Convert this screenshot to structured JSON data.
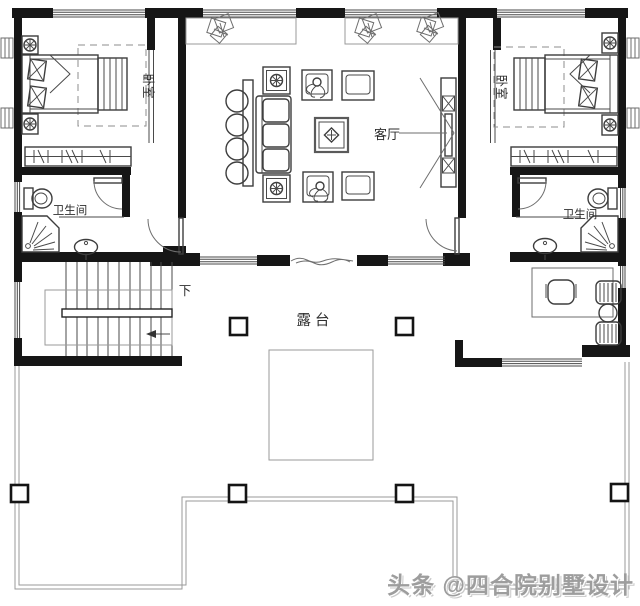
{
  "plan": {
    "rooms": {
      "bedroom_left": {
        "label": "卧室"
      },
      "bedroom_right": {
        "label": "卧室"
      },
      "bathroom_left": {
        "label": "卫生间"
      },
      "bathroom_right": {
        "label": "卫生间"
      },
      "living_room": {
        "label": "客厅"
      },
      "terrace": {
        "label": "露台"
      },
      "stairs": {
        "down_label": "下"
      }
    },
    "colors": {
      "wall": "#161616",
      "drawing_line": "#4a4a4a",
      "light_line": "#9a9a9a",
      "background": "#ffffff",
      "watermark": "#9d9d9d"
    }
  },
  "watermark": {
    "text": "头条 @四合院别墅设计"
  }
}
